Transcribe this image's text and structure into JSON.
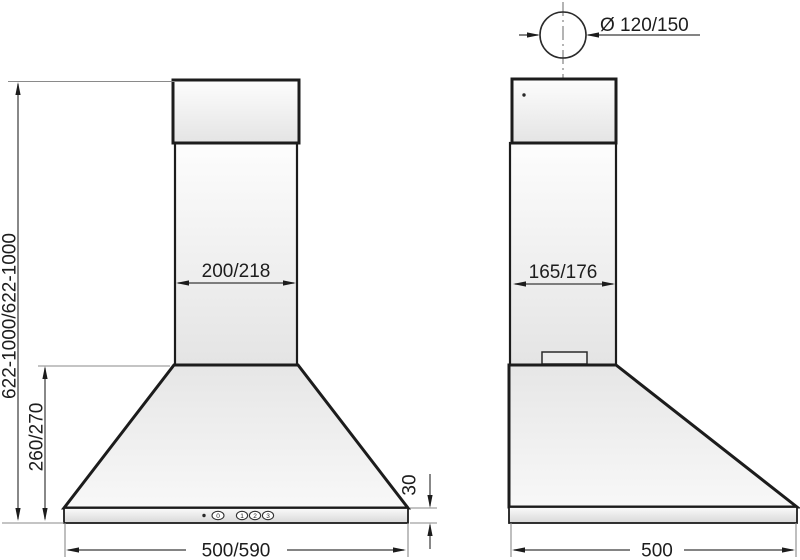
{
  "drawing": {
    "description": "Technical dimension drawing of a chimney cooker hood, front view and side view, dimensions in mm",
    "front_view": {
      "label_total_height": "622-1000/622-1000",
      "label_canopy_height": "260/270",
      "label_chimney_width": "200/218",
      "label_body_width": "500/590",
      "label_base_height": "30",
      "controls": {
        "indicator": "power-indicator-dot",
        "buttons": [
          "0",
          "1",
          "2",
          "3"
        ]
      }
    },
    "side_view": {
      "label_duct_diameter": "Ø 120/150",
      "label_chimney_depth": "165/176",
      "label_body_depth": "500"
    },
    "colors": {
      "background": "#ffffff",
      "outline": "#1c1c1c",
      "dimension_line": "#3a3a3a",
      "extension_line": "#8a8a8a",
      "centerline": "#6a6a6a",
      "fill_light": "#fdfdfd",
      "fill_shade": "#e2e2e2",
      "text": "#1d1d1d"
    }
  }
}
